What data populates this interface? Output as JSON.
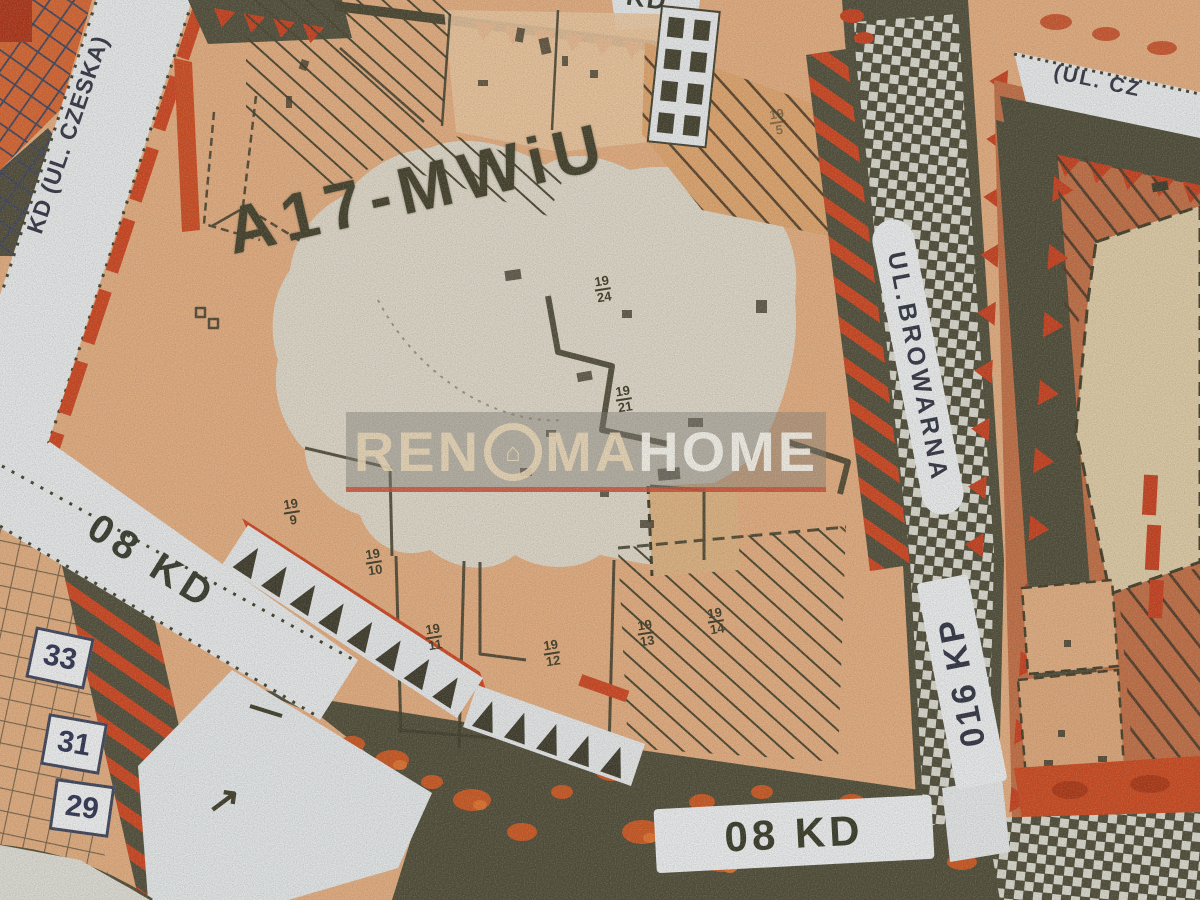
{
  "map": {
    "zone_label": "A17-MWiU",
    "streets": {
      "czeska_left": "KD (UL. CZESKA)",
      "czeska_top_right": "(UL. CZ",
      "kd_left": "08 KD",
      "kd_bottom": "08 KD",
      "kd_top_partial": "KD",
      "browarna": "UL.BROWARNA",
      "kp": "016 KP"
    },
    "house_numbers": [
      "33",
      "31",
      "29"
    ],
    "plots": [
      {
        "num": "19",
        "den": "5"
      },
      {
        "num": "19",
        "den": "24"
      },
      {
        "num": "19",
        "den": "21"
      },
      {
        "num": "19",
        "den": "9"
      },
      {
        "num": "19",
        "den": "10"
      },
      {
        "num": "19",
        "den": "11"
      },
      {
        "num": "19",
        "den": "12"
      },
      {
        "num": "19",
        "den": "13"
      },
      {
        "num": "19",
        "den": "14"
      }
    ],
    "symbols": {
      "direction_arrow": "↗"
    },
    "watermark": {
      "part1": "REN",
      "o_icon": "⌂",
      "part2": "MA",
      "part3": "HOME"
    }
  },
  "colors": {
    "parcel_peach": "#dea87c",
    "zone_light": "#d8d4c9",
    "street_white": "#e4e7ea",
    "boundary_red": "#c8411d",
    "olive_dark": "#4b4936",
    "salmon_right": "#bc6a42",
    "beige_parcel": "#d8c6a2",
    "orange_grid": "#d0602e",
    "label_dark": "#32362a",
    "navy_text": "#2b3048"
  }
}
